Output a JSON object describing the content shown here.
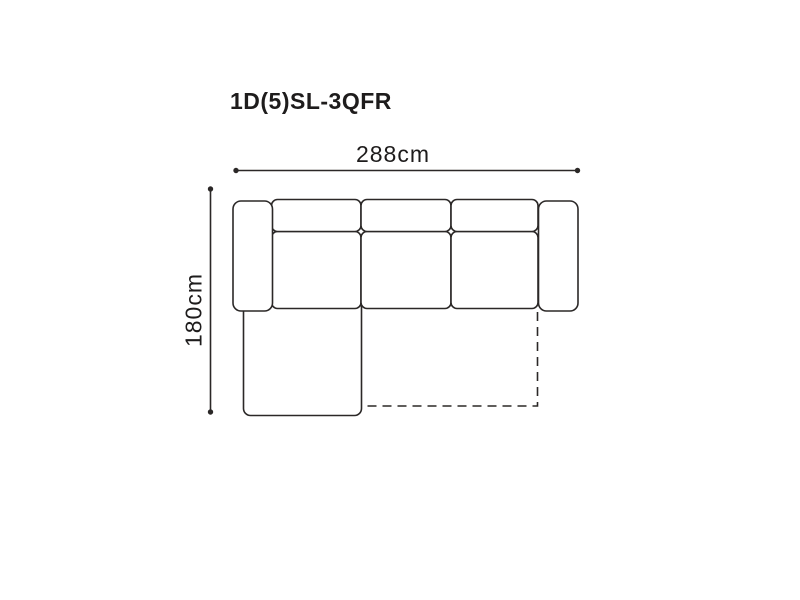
{
  "page": {
    "background": "#ffffff"
  },
  "product": {
    "model": "1D(5)SL-3QFR"
  },
  "dimensions": {
    "width_label": "288cm",
    "depth_label": "180cm"
  },
  "style": {
    "line_color": "#2b2827",
    "text_color": "#1e1c1c"
  },
  "diagram": {
    "type": "sofa-top-view-dimension-diagram",
    "parts": [
      "left-armrest",
      "backrest-cushion-1",
      "backrest-cushion-2",
      "backrest-cushion-3",
      "seat-cushion-1",
      "seat-cushion-2",
      "seat-cushion-3",
      "right-armrest",
      "chaise-longue",
      "fold-out-bed-dashed-outline"
    ]
  }
}
